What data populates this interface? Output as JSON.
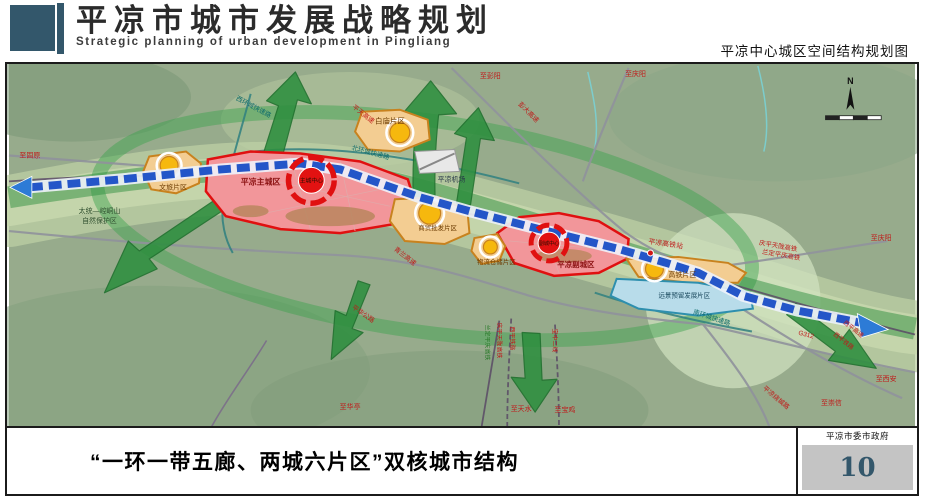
{
  "header": {
    "title": "平凉市城市发展战略规划",
    "subtitle_en": "Strategic planning of urban development in Pingliang",
    "map_title": "平凉中心城区空间结构规划图"
  },
  "footer": {
    "caption": "“一环一带五廊、两城六片区”双核城市结构",
    "agency": "平凉市委市政府",
    "page_number": "10"
  },
  "map": {
    "compass": "N",
    "districts": {
      "main_city": "平凉主城区",
      "main_center": "主城中心",
      "sub_city": "平凉副城区",
      "sub_center": "副城中心",
      "baimiao": "白庙片区",
      "wenlv": "文旅片区",
      "shangmao": "商贸批发片区",
      "wuliu": "物流仓储片区",
      "gaotie": "高铁片区",
      "yuanjing": "远景预留发展片区"
    },
    "nature_reserve": {
      "line1": "太统—崆峒山",
      "line2": "自然保护区"
    },
    "pois": {
      "airport": "平凉机场",
      "hsr_station": "平凉高铁站"
    },
    "roads": {
      "west_ring": "西环城快速路",
      "north_ring": "北环城快速路",
      "south_ring": "南环城快速路",
      "pingtian_expwy": "平天高速",
      "pengda_expwy": "彭大高速",
      "qinglan_expwy": "青兰高速",
      "g312": "G312",
      "xiping_expwy": "西平高速",
      "xiping_railway": "西平铁路",
      "raocheng_road": "平凉绕城路",
      "pinghua_road": "平华公路",
      "baozhong_line2": "宝中二线",
      "qingping_hsr": "庆平天陇高铁",
      "landing_hsr": "兰定平庆高铁"
    },
    "directions": {
      "to_guyuan": "至固原",
      "to_pengyang": "至彭阳",
      "to_qingyang_top": "至庆阳",
      "to_qingyang_east": "至庆阳",
      "to_xian": "至西安",
      "to_chongxin": "至崇信",
      "to_huating": "至华亭",
      "to_tianshui": "至天水",
      "to_baoji": "至宝鸡"
    }
  },
  "colors": {
    "accent_slate": "#33576b",
    "road_label_red": "#c01818",
    "ring_road_teal": "#0d6b6b",
    "zone_red_fill": "#f2969a",
    "zone_red_border": "#e01010",
    "zone_orange_fill": "#f3cd92",
    "zone_orange_border": "#c8821e",
    "zone_blue_fill": "#b8dcea",
    "corridor_green": "#2f9040",
    "belt_blue": "#2456c8",
    "node_yellow": "#f6b80e"
  }
}
